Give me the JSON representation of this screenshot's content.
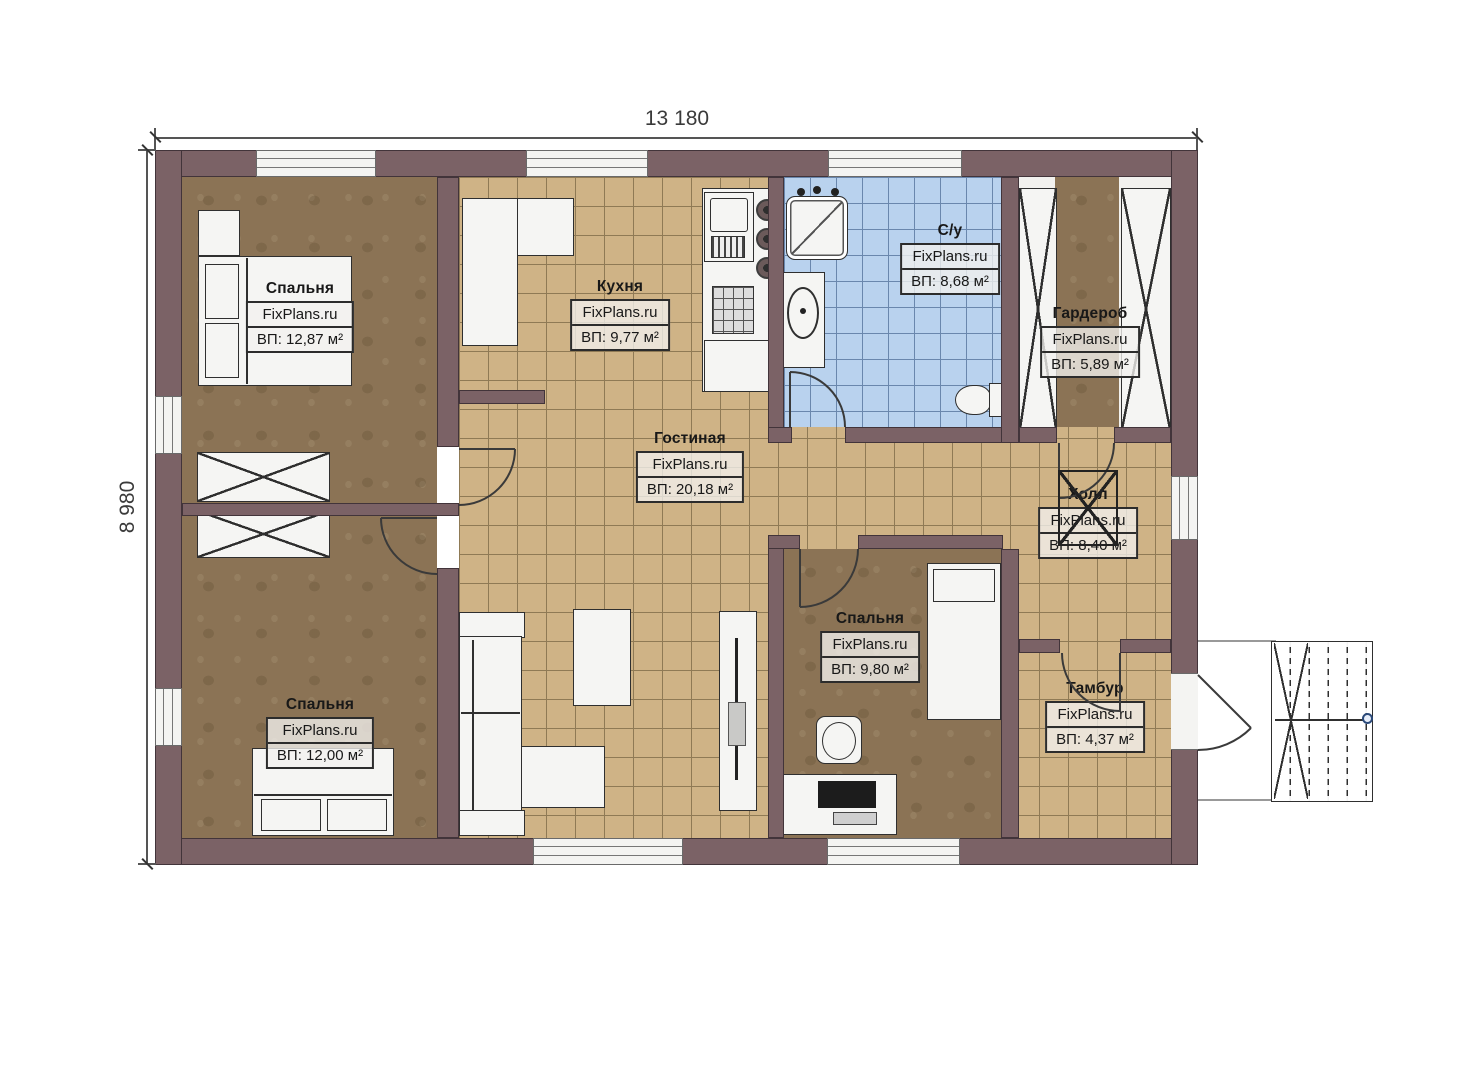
{
  "dimensions": {
    "width_label": "13 180",
    "height_label": "8 980"
  },
  "rooms": [
    {
      "id": "bedroom-top-left",
      "name": "Спальня",
      "brand": "FixPlans.ru",
      "area": "ВП: 12,87 м²"
    },
    {
      "id": "kitchen",
      "name": "Кухня",
      "brand": "FixPlans.ru",
      "area": "ВП: 9,77 м²"
    },
    {
      "id": "bathroom",
      "name": "С/у",
      "brand": "FixPlans.ru",
      "area": "ВП: 8,68 м²"
    },
    {
      "id": "wardrobe",
      "name": "Гардероб",
      "brand": "FixPlans.ru",
      "area": "ВП: 5,89 м²"
    },
    {
      "id": "living-room",
      "name": "Гостиная",
      "brand": "FixPlans.ru",
      "area": "ВП: 20,18 м²"
    },
    {
      "id": "hall",
      "name": "Холл",
      "brand": "FixPlans.ru",
      "area": "ВП: 8,40 м²"
    },
    {
      "id": "bedroom-middle",
      "name": "Спальня",
      "brand": "FixPlans.ru",
      "area": "ВП: 9,80 м²"
    },
    {
      "id": "vestibule",
      "name": "Тамбур",
      "brand": "FixPlans.ru",
      "area": "ВП: 4,37 м²"
    },
    {
      "id": "bedroom-bottom-left",
      "name": "Спальня",
      "brand": "FixPlans.ru",
      "area": "ВП: 12,00 м²"
    }
  ],
  "colors": {
    "wall": "#7b6266",
    "wall-line": "#42343a",
    "bedfloor": "#8b7355",
    "tile": "#cfb386",
    "tilegrid": "#8f7a55",
    "bath": "#b9d2ee",
    "bathgrid": "#6a87ad",
    "furn": "#f5f5f3",
    "line": "#2f2f2f",
    "dim": "#3a3a3a",
    "stairdot": "#2b4a7a"
  }
}
